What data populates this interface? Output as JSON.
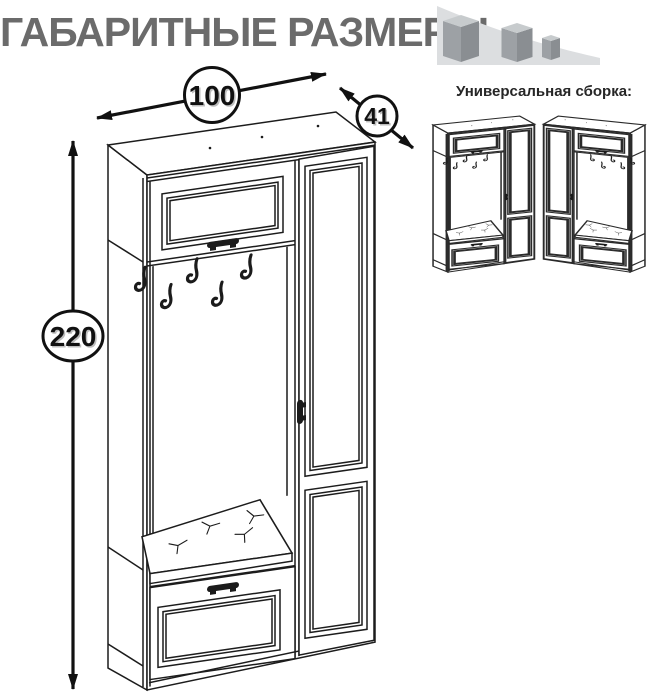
{
  "title": {
    "text": "ГАБАРИТНЫЕ РАЗМЕРЫ",
    "color": "#6b6b6b"
  },
  "dimensions": {
    "width": "100",
    "depth": "41",
    "height": "220"
  },
  "assembly": {
    "label": "Универсальная сборка:"
  },
  "icons": {
    "size_cubes": "three-descending-cubes-on-swoosh"
  },
  "colors": {
    "outline": "#1c1c1c",
    "title": "#6b6b6b",
    "swoosh": "#dcdee0",
    "cube_top": "#c7cbcd",
    "cube_left": "#9da1a5",
    "cube_right": "#8a8e92",
    "dimension_text": "#111111"
  }
}
